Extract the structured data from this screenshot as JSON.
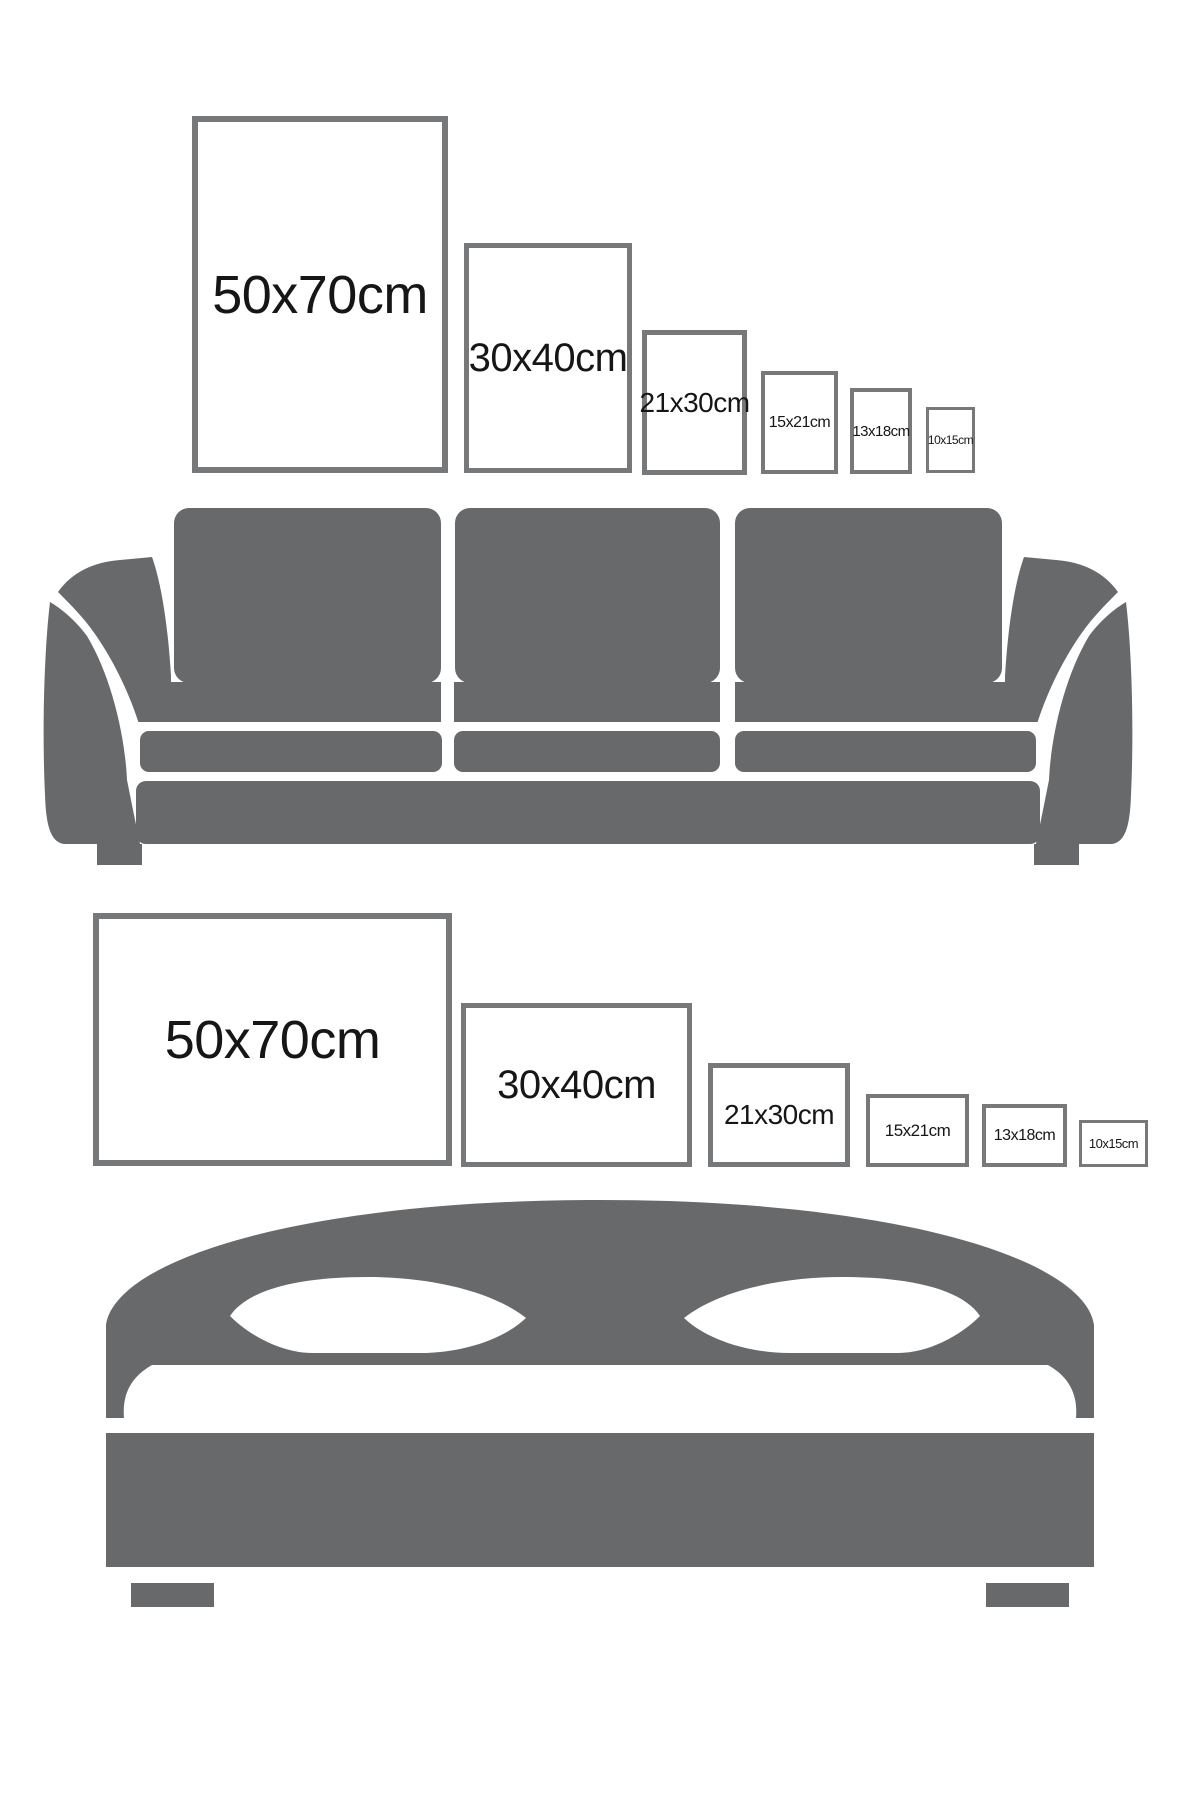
{
  "title": "Poster frame size guide over sofa and bed",
  "colors": {
    "furniture_gray": "#68696b",
    "frame_border": "#77787a",
    "label_text": "#161616",
    "background": "#ffffff"
  },
  "sofa_section": {
    "furniture": "sofa",
    "orientation": "portrait",
    "frames": [
      {
        "label": "50x70cm"
      },
      {
        "label": "30x40cm"
      },
      {
        "label": "21x30cm"
      },
      {
        "label": "15x21cm"
      },
      {
        "label": "13x18cm"
      },
      {
        "label": "10x15cm"
      }
    ]
  },
  "bed_section": {
    "furniture": "bed",
    "orientation": "landscape",
    "frames": [
      {
        "label": "50x70cm"
      },
      {
        "label": "30x40cm"
      },
      {
        "label": "21x30cm"
      },
      {
        "label": "15x21cm"
      },
      {
        "label": "13x18cm"
      },
      {
        "label": "10x15cm"
      }
    ]
  }
}
